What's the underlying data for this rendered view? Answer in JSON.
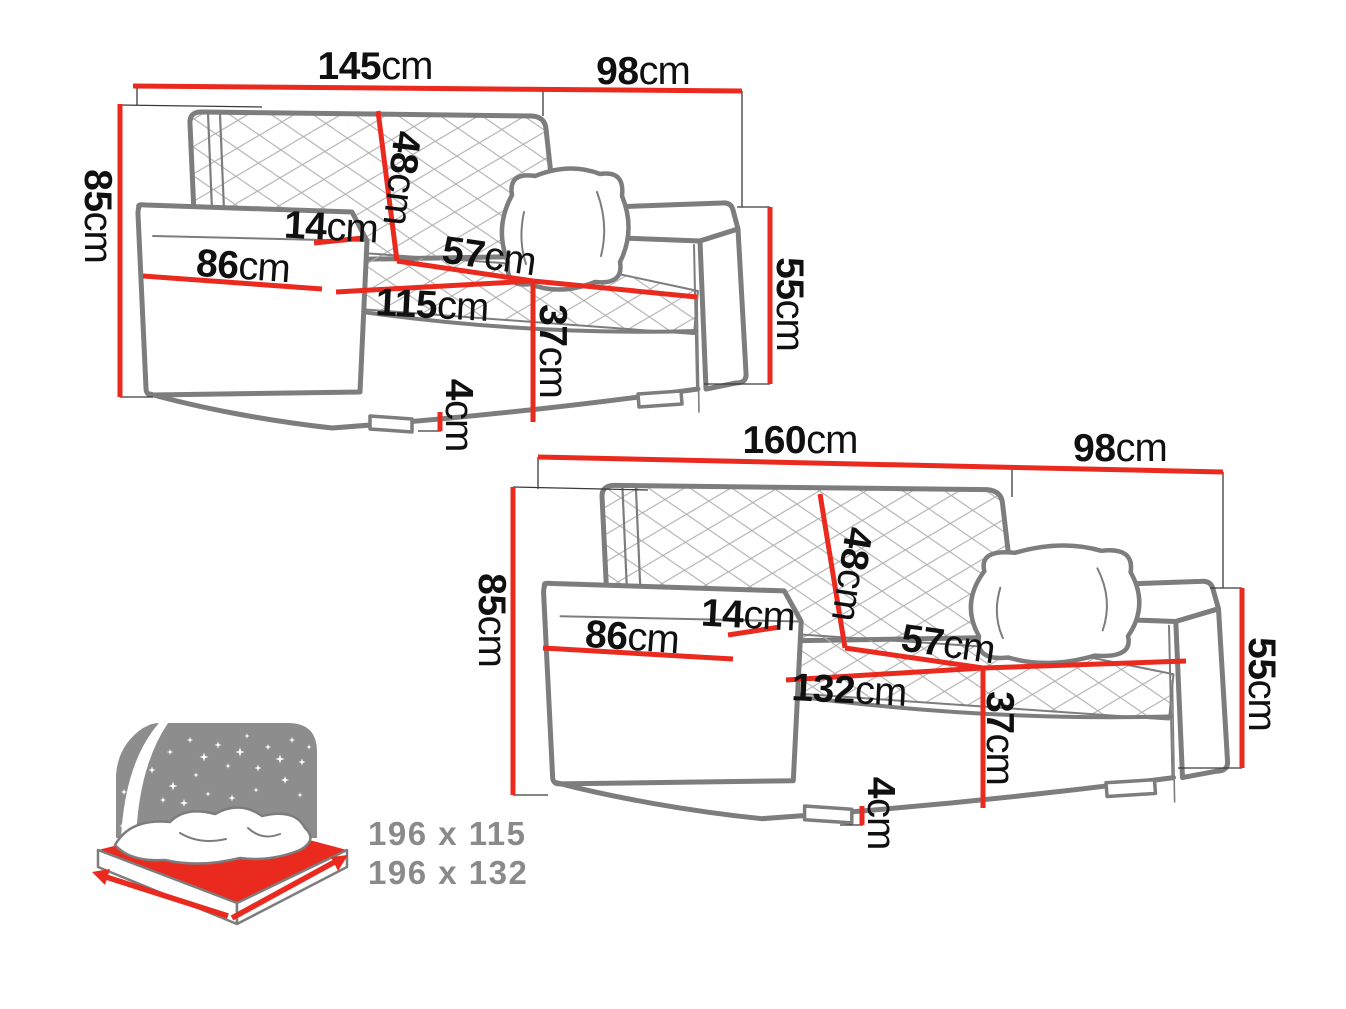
{
  "figure": {
    "type": "sofa-dimension-diagram",
    "sofas": [
      {
        "name": "sofa-145",
        "labels": {
          "width": {
            "value": "145",
            "unit": "cm"
          },
          "depth": {
            "value": "98",
            "unit": "cm"
          },
          "height": {
            "value": "85",
            "unit": "cm"
          },
          "backrest_height": {
            "value": "48",
            "unit": "cm"
          },
          "armrest_width": {
            "value": "14",
            "unit": "cm"
          },
          "armrest_depth": {
            "value": "86",
            "unit": "cm"
          },
          "seat_depth": {
            "value": "57",
            "unit": "cm"
          },
          "seat_width": {
            "value": "115",
            "unit": "cm"
          },
          "front_height": {
            "value": "55",
            "unit": "cm"
          },
          "seat_height": {
            "value": "37",
            "unit": "cm"
          },
          "leg_height": {
            "value": "4",
            "unit": "cm"
          }
        }
      },
      {
        "name": "sofa-160",
        "labels": {
          "width": {
            "value": "160",
            "unit": "cm"
          },
          "depth": {
            "value": "98",
            "unit": "cm"
          },
          "height": {
            "value": "85",
            "unit": "cm"
          },
          "backrest_height": {
            "value": "48",
            "unit": "cm"
          },
          "armrest_width": {
            "value": "14",
            "unit": "cm"
          },
          "armrest_depth": {
            "value": "86",
            "unit": "cm"
          },
          "seat_depth": {
            "value": "57",
            "unit": "cm"
          },
          "seat_width": {
            "value": "132",
            "unit": "cm"
          },
          "front_height": {
            "value": "55",
            "unit": "cm"
          },
          "seat_height": {
            "value": "37",
            "unit": "cm"
          },
          "leg_height": {
            "value": "4",
            "unit": "cm"
          }
        }
      }
    ],
    "bed_icon": {
      "name": "sleeping-area-icon",
      "sizes": [
        "196 x 115",
        "196 x 132"
      ]
    },
    "colors": {
      "dimension_line": "#ea2a1f",
      "sofa_outline": "#7d7d7d",
      "quilt_line": "#b0b0b0",
      "tick_line": "#3a3a3a",
      "label_text": "#101010",
      "bed_text": "#8a8a8a",
      "bed_graphic": "#8d8d8d",
      "background": "#ffffff"
    }
  }
}
